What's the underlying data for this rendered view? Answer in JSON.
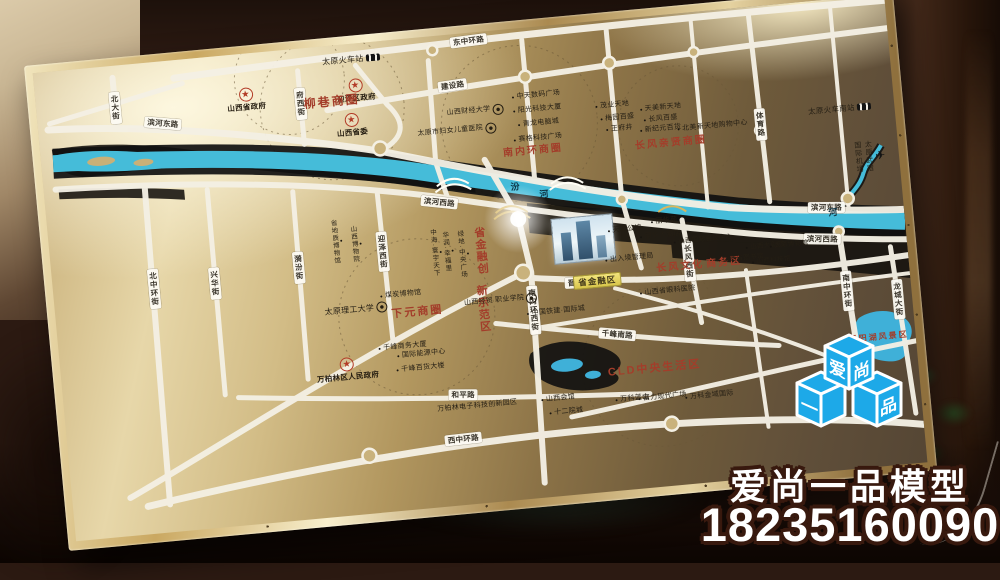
{
  "watermark": {
    "company": "爱尚一品模型",
    "phone": "18235160090",
    "accent_color": "#1da9e8",
    "cubes": {
      "top_left": "爱",
      "top_right": "尚",
      "bottom_left": "一",
      "bottom_right": "品"
    }
  },
  "map": {
    "river_name": "汾河",
    "red_color": "#a33d2a",
    "water_color": "#45bcd9",
    "project_label": "省金融区",
    "labels": [
      {
        "t": "东中环路",
        "x": 437,
        "y": 8,
        "type": "road",
        "rot": -2
      },
      {
        "t": "建设路",
        "x": 417,
        "y": 51,
        "type": "road",
        "rot": -3
      },
      {
        "t": "滨河东路",
        "x": 125,
        "y": 62,
        "type": "road",
        "rot": 10
      },
      {
        "t": "滨河东路",
        "x": 778,
        "y": 207,
        "type": "road",
        "rot": 5
      },
      {
        "t": "滨河西路",
        "x": 393,
        "y": 166,
        "type": "road",
        "rot": 11
      },
      {
        "t": "滨河西路",
        "x": 771,
        "y": 238,
        "type": "road",
        "rot": 6
      },
      {
        "t": "北大街",
        "x": 79,
        "y": 42,
        "type": "road",
        "v": 1
      },
      {
        "t": "府西街",
        "x": 264,
        "y": 55,
        "type": "road",
        "v": 1
      },
      {
        "t": "北中环街",
        "x": 101,
        "y": 226,
        "type": "road",
        "v": 1
      },
      {
        "t": "兴华街",
        "x": 162,
        "y": 226,
        "type": "road",
        "v": 1
      },
      {
        "t": "漪汾街",
        "x": 247,
        "y": 218,
        "type": "road",
        "v": 1
      },
      {
        "t": "迎泽西街",
        "x": 332,
        "y": 210,
        "type": "road",
        "v": 1
      },
      {
        "t": "南内环西街",
        "x": 477,
        "y": 282,
        "type": "road",
        "v": 1
      },
      {
        "t": "长风西街",
        "x": 636,
        "y": 248,
        "type": "road",
        "v": 1
      },
      {
        "t": "体育路",
        "x": 720,
        "y": 118,
        "type": "road",
        "v": 1
      },
      {
        "t": "南中环街",
        "x": 791,
        "y": 292,
        "type": "road",
        "v": 1
      },
      {
        "t": "龙城大街",
        "x": 841,
        "y": 305,
        "type": "road",
        "v": 1
      },
      {
        "t": "晋祠路",
        "x": 525,
        "y": 259,
        "type": "road",
        "rot": 2
      },
      {
        "t": "千峰南路",
        "x": 558,
        "y": 314,
        "type": "road",
        "rot": 10
      },
      {
        "t": "和平路",
        "x": 399,
        "y": 360,
        "type": "road",
        "rot": 5
      },
      {
        "t": "西中环路",
        "x": 395,
        "y": 404,
        "type": "road",
        "rot": -1
      },
      {
        "t": "汾",
        "x": 470,
        "y": 158,
        "type": "river"
      },
      {
        "t": "河",
        "x": 498,
        "y": 168,
        "type": "river"
      },
      {
        "t": "河",
        "x": 784,
        "y": 213,
        "type": "river"
      },
      {
        "t": "太原火车站",
        "x": 318,
        "y": 16,
        "type": "place",
        "icon": "train",
        "size": 8
      },
      {
        "t": "太原火车南站",
        "x": 800,
        "y": 110,
        "type": "place",
        "icon": "train",
        "size": 7.5
      },
      {
        "lines": [
          "太原武宿",
          "国际机场"
        ],
        "x": 826,
        "y": 160,
        "type": "place",
        "v": 1,
        "icon": "plane",
        "size": 7
      },
      {
        "t": "山西省政府",
        "x": 210,
        "y": 46,
        "type": "gov",
        "star": 1
      },
      {
        "t": "迎泽区政府",
        "x": 320,
        "y": 47,
        "type": "gov",
        "star": 1
      },
      {
        "t": "山西省委",
        "x": 313,
        "y": 81,
        "type": "gov",
        "star": 1
      },
      {
        "t": "万柏林区人民政府",
        "x": 286,
        "y": 324,
        "type": "gov",
        "star": 1
      },
      {
        "t": "柳巷商圈",
        "x": 295,
        "y": 56,
        "type": "zone",
        "size": 12
      },
      {
        "t": "南内环商圈",
        "x": 491,
        "y": 124,
        "type": "zone",
        "size": 10
      },
      {
        "t": "长风亲贤商圈",
        "x": 629,
        "y": 129,
        "type": "zone",
        "size": 10
      },
      {
        "lines": [
          "长风文化",
          "商务区"
        ],
        "x": 646,
        "y": 253,
        "type": "zone",
        "size": 10
      },
      {
        "t": "下元商圈",
        "x": 361,
        "y": 274,
        "type": "zone",
        "size": 11
      },
      {
        "t": "CLD中央生活区",
        "x": 592,
        "y": 352,
        "type": "zone",
        "size": 11
      },
      {
        "t": "省金融创",
        "x": 429,
        "y": 218,
        "type": "zone",
        "v": 1,
        "size": 11
      },
      {
        "t": "新示范区",
        "x": 426,
        "y": 276,
        "type": "zone",
        "v": 1,
        "size": 11
      },
      {
        "t": "晋阳湖风景区",
        "x": 818,
        "y": 341,
        "type": "zone",
        "size": 8
      },
      {
        "t": "山西财经大学",
        "x": 437,
        "y": 79,
        "type": "place",
        "icon": "circle"
      },
      {
        "t": "太原市妇女儿童医院",
        "x": 417,
        "y": 97,
        "type": "place",
        "icon": "circle"
      },
      {
        "t": "中天数码广场",
        "x": 499,
        "y": 69,
        "type": "place",
        "dot": 1
      },
      {
        "t": "阳光科技大厦",
        "x": 499,
        "y": 83,
        "type": "place",
        "dot": 1
      },
      {
        "t": "青龙电脑城",
        "x": 499,
        "y": 97,
        "type": "place",
        "dot": 1
      },
      {
        "t": "赛格科技广场",
        "x": 497,
        "y": 112,
        "type": "place",
        "dot": 1
      },
      {
        "t": "茂业天地",
        "x": 574,
        "y": 86,
        "type": "place",
        "dot": 1
      },
      {
        "t": "梅园百盛",
        "x": 578,
        "y": 99,
        "type": "place",
        "dot": 1
      },
      {
        "t": "王府井",
        "x": 579,
        "y": 110,
        "type": "place",
        "dot": 1
      },
      {
        "t": "天美新天地",
        "x": 622,
        "y": 93,
        "type": "place",
        "dot": 1
      },
      {
        "t": "长风百盛",
        "x": 621,
        "y": 104,
        "type": "place",
        "dot": 1
      },
      {
        "t": "新纪元百货",
        "x": 620,
        "y": 114,
        "type": "place",
        "dot": 1
      },
      {
        "t": "北美新天地购物中心",
        "x": 672,
        "y": 116,
        "type": "place",
        "dot": 1
      },
      {
        "t": "省地质博物馆",
        "x": 287,
        "y": 196,
        "type": "place",
        "v": 1,
        "dot": 1,
        "size": 6.5
      },
      {
        "t": "山西博物院",
        "x": 306,
        "y": 200,
        "type": "place",
        "v": 1,
        "dot": 1,
        "size": 6.5
      },
      {
        "t": "中海·寰宇天下",
        "x": 385,
        "y": 216,
        "type": "place",
        "v": 1,
        "dot": 1,
        "size": 6.5
      },
      {
        "t": "华润·幸福里",
        "x": 397,
        "y": 216,
        "type": "place",
        "v": 1,
        "dot": 1,
        "size": 6.5
      },
      {
        "t": "绿地·中央广场",
        "x": 412,
        "y": 220,
        "type": "place",
        "v": 1,
        "dot": 1,
        "size": 6.5
      },
      {
        "t": "煤炭博物馆",
        "x": 346,
        "y": 255,
        "type": "place",
        "dot": 1
      },
      {
        "t": "太原理工大学",
        "x": 300,
        "y": 265,
        "type": "place",
        "icon": "circle",
        "size": 8
      },
      {
        "t": "千峰商务大厦",
        "x": 343,
        "y": 307,
        "type": "place",
        "dot": 1
      },
      {
        "t": "国际能源中心",
        "x": 361,
        "y": 316,
        "type": "place",
        "dot": 1
      },
      {
        "t": "千峰百货大楼",
        "x": 359,
        "y": 330,
        "type": "place",
        "dot": 1
      },
      {
        "t": "万柏林电子科技创新园区",
        "x": 412,
        "y": 373,
        "type": "place"
      },
      {
        "lines": [
          "山西经贸",
          "职业学院"
        ],
        "x": 445,
        "y": 270,
        "type": "place",
        "icon": "circle"
      },
      {
        "t": "中国铁建·国际城",
        "x": 499,
        "y": 286,
        "type": "place",
        "dot": 1
      },
      {
        "t": "山西省眼科医院",
        "x": 612,
        "y": 276,
        "type": "place",
        "dot": 1
      },
      {
        "t": "山西会馆",
        "x": 493,
        "y": 373,
        "type": "place",
        "dot": 1
      },
      {
        "t": "十二院城",
        "x": 500,
        "y": 387,
        "type": "place",
        "dot": 1
      },
      {
        "t": "万科蓝山",
        "x": 567,
        "y": 380,
        "type": "place",
        "dot": 1
      },
      {
        "t": "富力现代广场",
        "x": 597,
        "y": 381,
        "type": "place",
        "dot": 1
      },
      {
        "t": "万科金域国际",
        "x": 644,
        "y": 384,
        "type": "place",
        "dot": 1
      },
      {
        "t": "天安公馆",
        "x": 575,
        "y": 211,
        "type": "place",
        "dot": 1
      },
      {
        "t": "丽华苑",
        "x": 615,
        "y": 206,
        "type": "place",
        "dot": 1
      },
      {
        "t": "丽华大酒店",
        "x": 610,
        "y": 220,
        "type": "place",
        "dot": 1
      },
      {
        "t": "出入境管理局",
        "x": 577,
        "y": 240,
        "type": "place",
        "dot": 1
      },
      {
        "t": "山西国际会议中心",
        "x": 652,
        "y": 228,
        "type": "place",
        "dot": 1,
        "size": 6.5
      },
      {
        "t": "山西省图书馆",
        "x": 688,
        "y": 250,
        "type": "place",
        "dot": 1,
        "size": 6.5
      },
      {
        "t": "山西大剧院",
        "x": 713,
        "y": 240,
        "type": "place",
        "dot": 1,
        "size": 6.5
      },
      {
        "t": "太原博物馆",
        "x": 737,
        "y": 241,
        "type": "place",
        "dot": 1,
        "size": 6.5
      },
      {
        "t": "山西科技馆",
        "x": 718,
        "y": 255,
        "type": "place",
        "dot": 1,
        "size": 6.5
      },
      {
        "t": "省金融区",
        "x": 543,
        "y": 259,
        "type": "project"
      }
    ]
  }
}
